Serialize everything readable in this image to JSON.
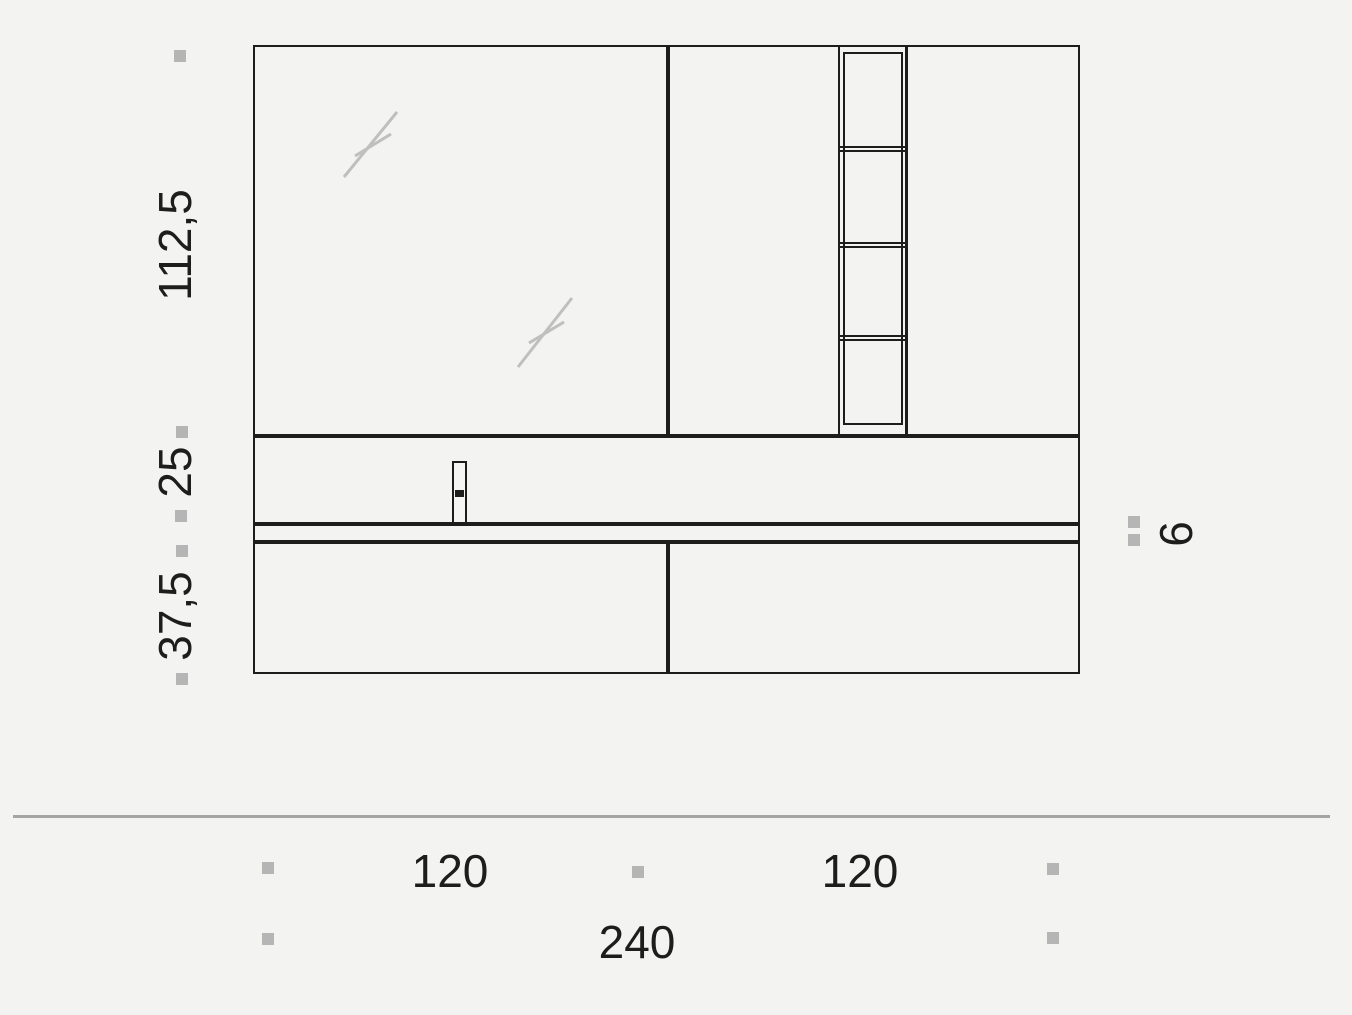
{
  "drawing": {
    "labels": {
      "mirror_height": "112,5",
      "basin_unit_height": "25",
      "drawer_unit_height": "37,5",
      "top_thickness": "6",
      "left_module_width": "120",
      "right_module_width": "120",
      "total_width": "240"
    },
    "colors": {
      "background": "#f3f3f1",
      "line": "#1d1d1b",
      "marker": "#b5b5b5",
      "hatch": "#bfbfbf",
      "separator": "#a5a5a5",
      "fill": "#f5f5f3"
    }
  }
}
